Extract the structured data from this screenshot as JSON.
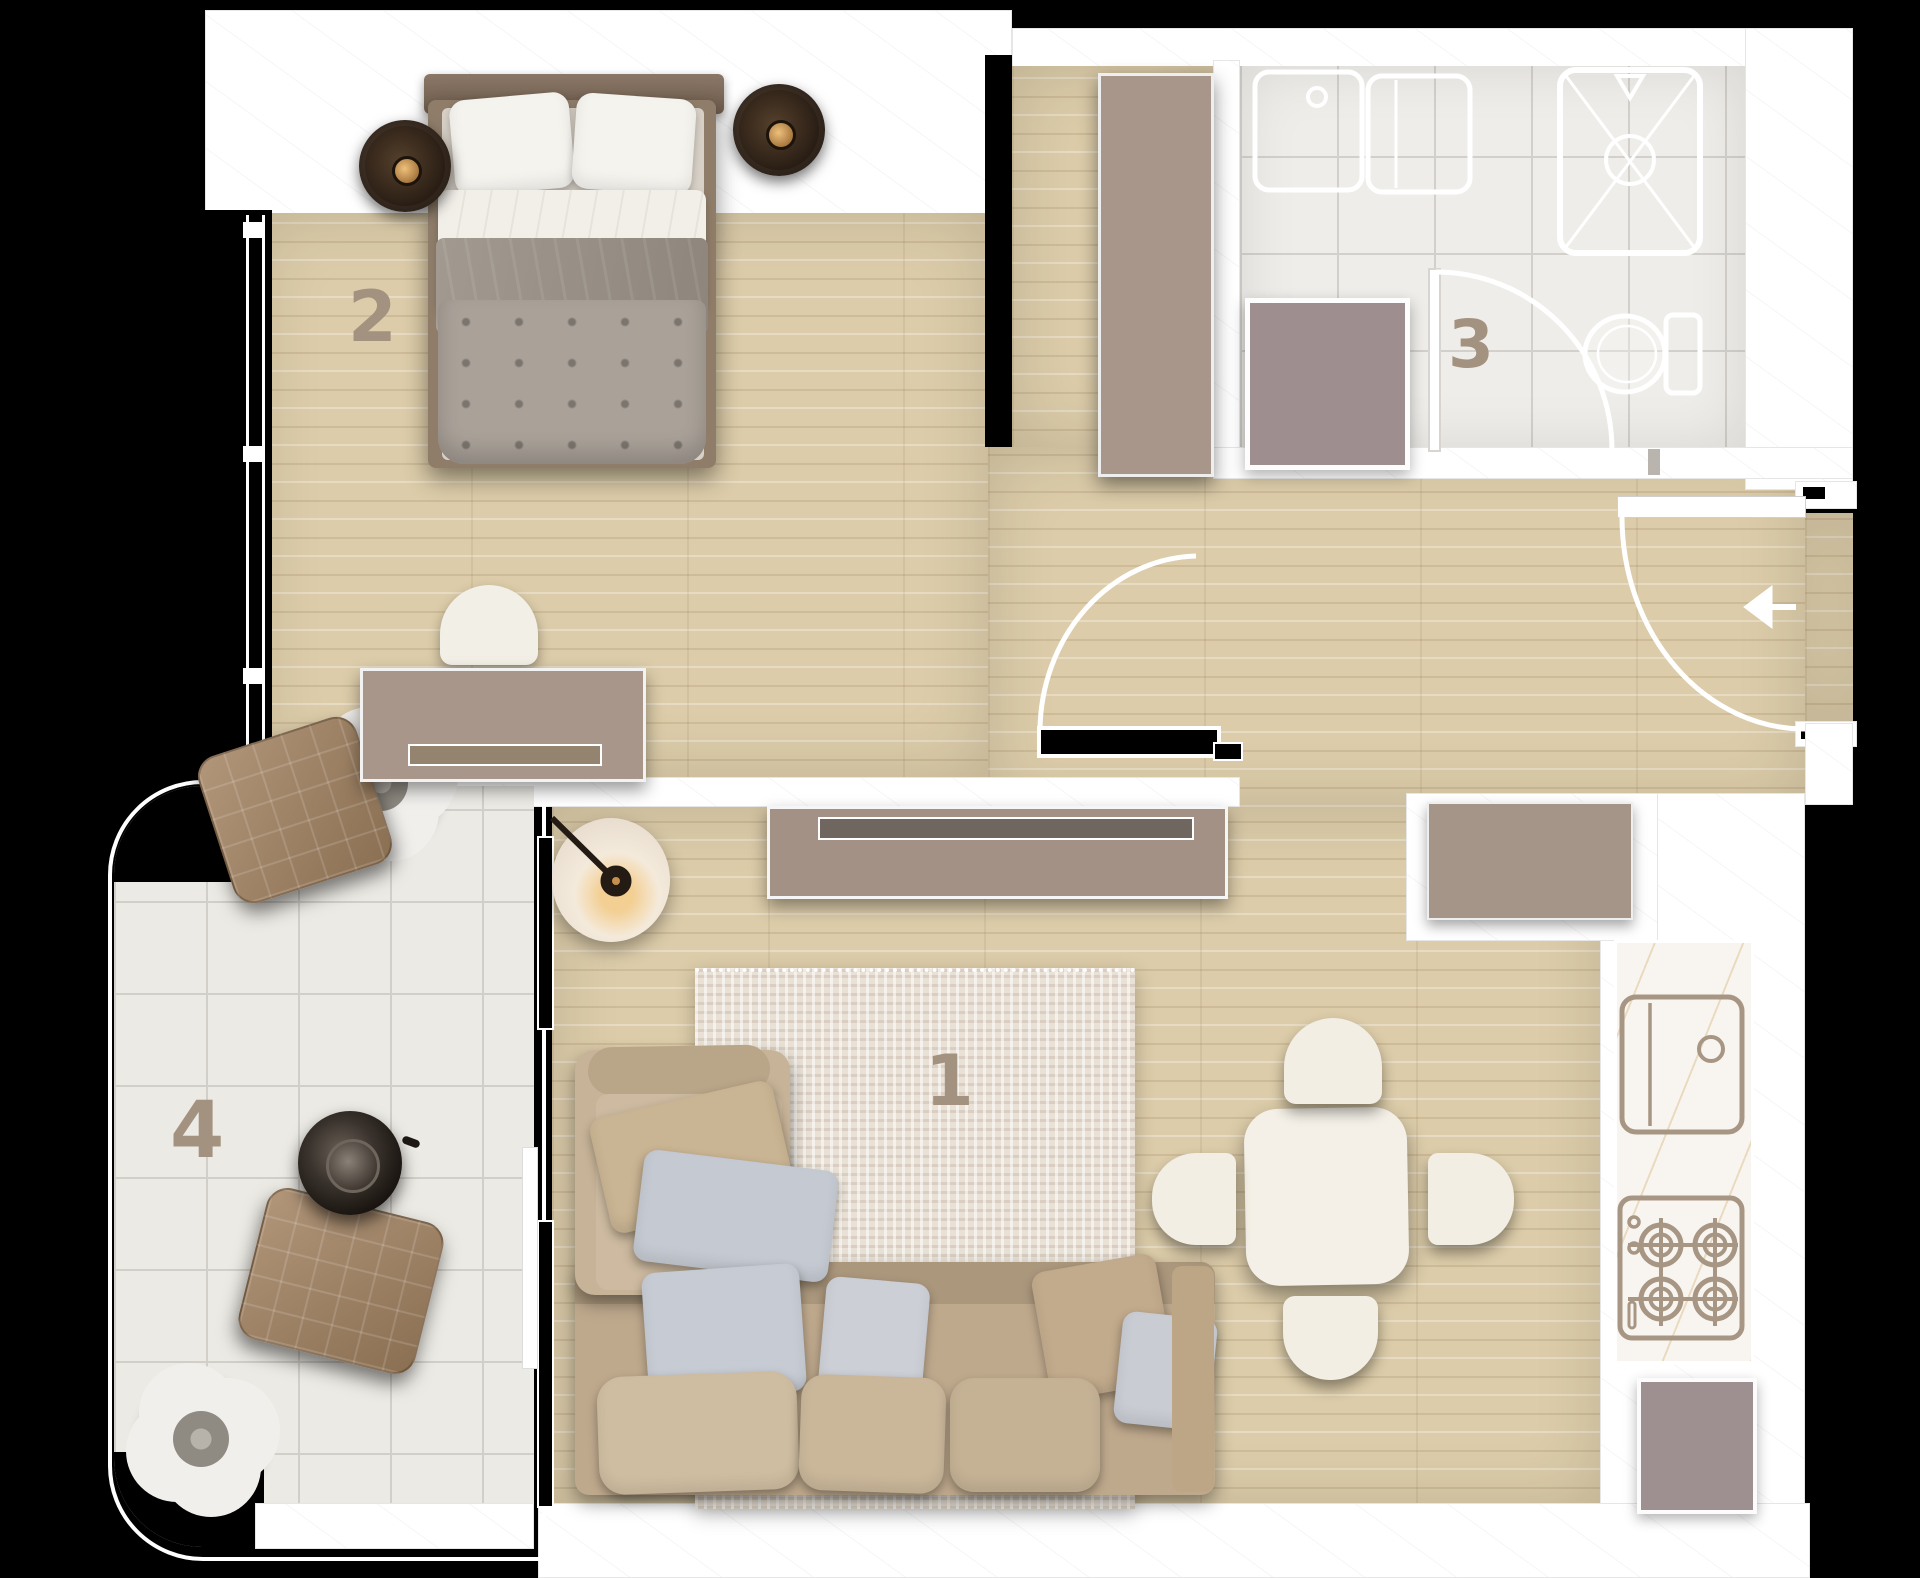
{
  "plan_title": "apartment-floor-plan",
  "rooms": [
    {
      "number": "1",
      "name": "living-room"
    },
    {
      "number": "2",
      "name": "bedroom"
    },
    {
      "number": "3",
      "name": "bathroom"
    },
    {
      "number": "4",
      "name": "balcony"
    }
  ],
  "fixtures": [
    "vanity-sink",
    "counter-basin",
    "shower",
    "toilet",
    "washer-closet",
    "kitchen-sink",
    "gas-stove",
    "fridge",
    "entry-door",
    "bedroom-door",
    "bathroom-door",
    "balcony-sliding-door",
    "entry-arrow"
  ],
  "colors": {
    "background": "#000000",
    "wall": "#ffffff",
    "wood_floor": "#dccca9",
    "tile_floor": "#efede9",
    "furniture_taupe": "#a79689",
    "appliance_mauve": "#9e8e90",
    "room_number": "#a3927f",
    "fixture_outline": "#a79683",
    "sofa_beige": "#bfa98d",
    "pillow_grey": "#c6cad2",
    "lamp_dark": "#2a2017"
  }
}
